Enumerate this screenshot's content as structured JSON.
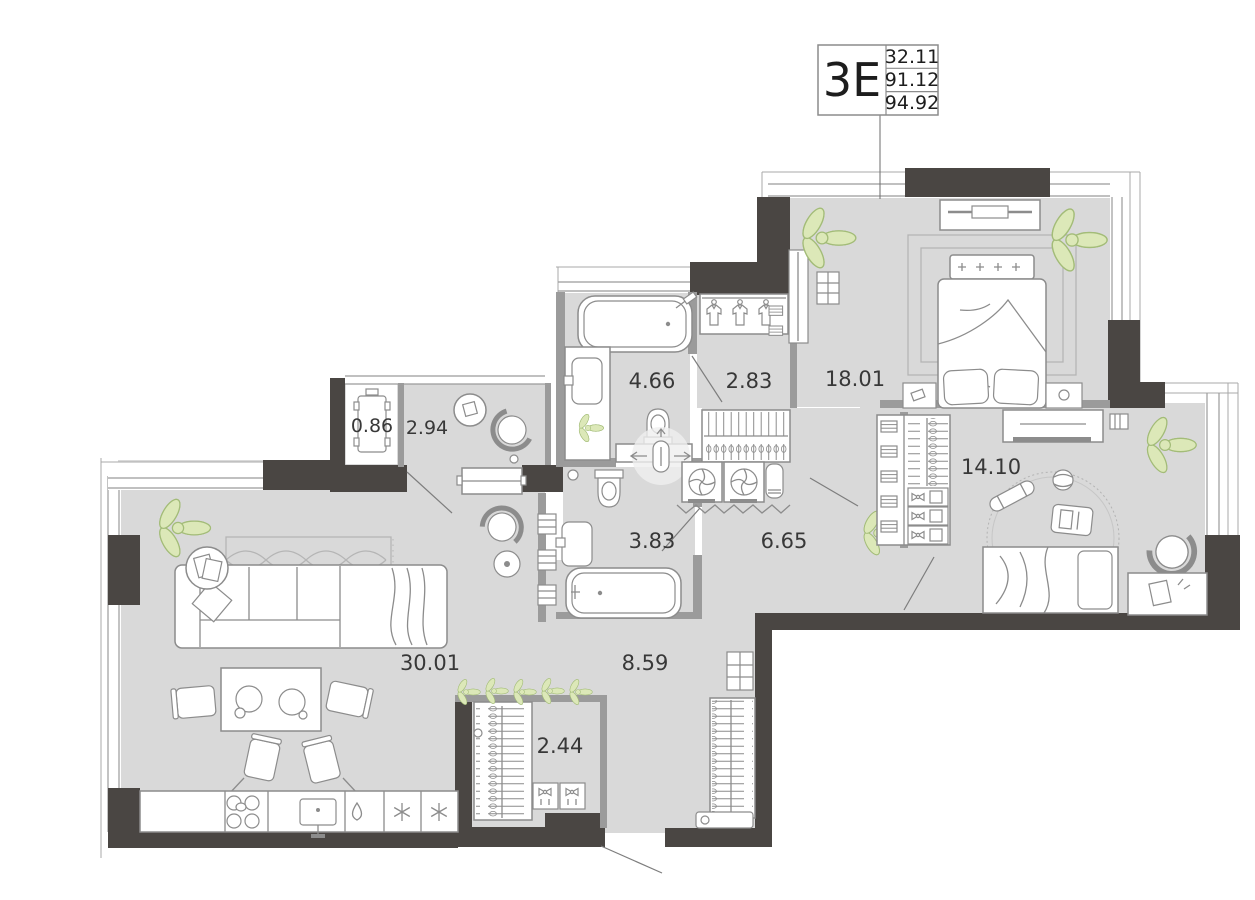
{
  "title_block": {
    "type_label": "3Е",
    "rows": [
      "32.11",
      "91.12",
      "94.92"
    ]
  },
  "rooms": [
    {
      "id": "living-kitchen",
      "area": "30.01"
    },
    {
      "id": "hallway",
      "area": "8.59"
    },
    {
      "id": "hall-closet",
      "area": "2.44"
    },
    {
      "id": "bathroom-2",
      "area": "3.83"
    },
    {
      "id": "laundry-hall",
      "area": "6.65"
    },
    {
      "id": "bathroom-1",
      "area": "4.66"
    },
    {
      "id": "wardrobe",
      "area": "2.83"
    },
    {
      "id": "bedroom",
      "area": "18.01"
    },
    {
      "id": "kids-room",
      "area": "14.10"
    },
    {
      "id": "lounge",
      "area": "2.94"
    },
    {
      "id": "balcony",
      "area": "0.86"
    }
  ],
  "colors": {
    "wall": "#4a4643",
    "partition": "#9b9b9b",
    "floor": "#d9d9d9",
    "plant": "#dce8b8",
    "furniture_stroke": "#8c8c8c"
  }
}
